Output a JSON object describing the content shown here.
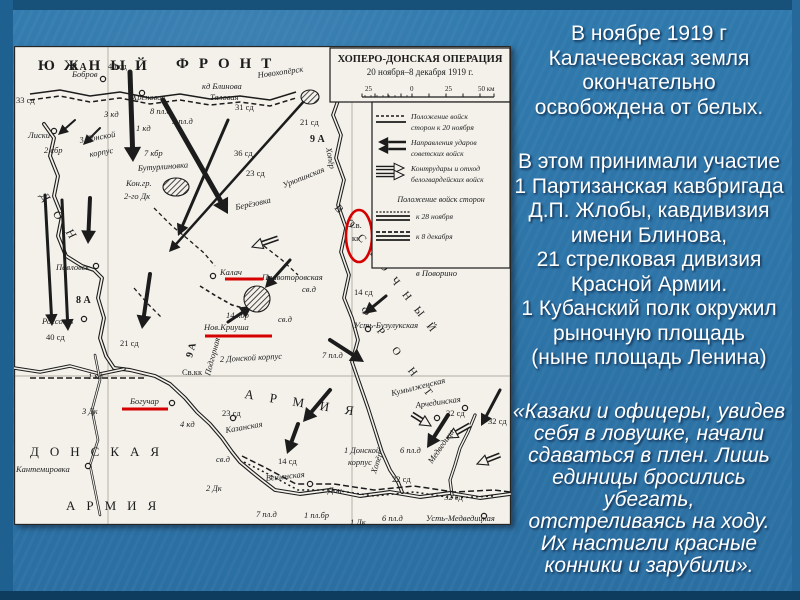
{
  "slide": {
    "background_color": "#2e76a9",
    "frame_color": "#175079",
    "text_color": "#ffffff",
    "paragraph1": {
      "lines": [
        "В ноябре 1919 г",
        "Калачеевская земля",
        "окончательно",
        "освобождена от белых."
      ]
    },
    "paragraph2": {
      "lines": [
        "В этом принимали участие",
        "1 Партизанская кавбригада",
        "Д.П. Жлобы,  кавдивизия",
        "имени Блинова,",
        "21 стрелковая дивизия",
        "Красной Армии.",
        "1 Кубанский полк окружил",
        "рыночную площадь",
        "(ныне площадь Ленина)"
      ]
    },
    "quote": {
      "lines": [
        "«Казаки и офицеры, увидев",
        "себя в ловушке,  начали",
        "сдаваться в плен. Лишь",
        "единицы бросились",
        "убегать,",
        "отстреливаясь на ходу.",
        "Их настигли красные",
        "конники и зарубили»."
      ]
    }
  },
  "map": {
    "paper_color": "#f3f1ea",
    "ink_color": "#1c1c1c",
    "red_color": "#d60000",
    "title": {
      "line1": "ХОПЕРО-ДОНСКАЯ ОПЕРАЦИЯ",
      "line2": "20 ноября–8 декабря 1919 г."
    },
    "scale": {
      "labels": [
        "25",
        "0",
        "25",
        "50 км"
      ]
    },
    "legend": {
      "item1": [
        "Положение войск",
        "сторон к 20 ноября"
      ],
      "item2": [
        "Направления ударов",
        "советских войск"
      ],
      "item3": [
        "Контрудары и отход",
        "белогвардейских войск"
      ],
      "header": "Положение войск сторон",
      "item4": "к 28 ноября",
      "item5": "к 8 декабря"
    },
    "grid": {
      "verticals": [
        94,
        338
      ],
      "horizontals": [
        330
      ]
    },
    "labels": [
      {
        "t": "ЮЖНЫЙ",
        "x": 24,
        "y": 24,
        "s": 15,
        "sp": 10,
        "b": 1
      },
      {
        "t": "ФРОНТ",
        "x": 162,
        "y": 22,
        "s": 15,
        "sp": 10,
        "b": 1
      },
      {
        "t": "ДОНСКАЯ",
        "x": 16,
        "y": 410,
        "s": 13,
        "sp": 11
      },
      {
        "t": "АРМИЯ",
        "x": 52,
        "y": 464,
        "s": 13,
        "sp": 11
      },
      {
        "t": "АРМИЯ",
        "x": 230,
        "y": 352,
        "s": 13,
        "sp": 16,
        "r": 9
      },
      {
        "t": "ДОН",
        "x": 26,
        "y": 150,
        "s": 12,
        "sp": 14,
        "r": 55,
        "i": 1
      },
      {
        "t": "ВОСТОЧНЫЙ",
        "x": 320,
        "y": 162,
        "s": 11,
        "sp": 11,
        "r": 52
      },
      {
        "t": "ФРОНТ",
        "x": 346,
        "y": 264,
        "s": 11,
        "sp": 18,
        "r": 52
      },
      {
        "t": "8 А",
        "x": 58,
        "y": 24,
        "s": 10,
        "b": 1
      },
      {
        "t": "40 сд",
        "x": 94,
        "y": 23
      },
      {
        "t": "Бобров",
        "x": 58,
        "y": 31,
        "i": 1
      },
      {
        "t": "кд Блинова",
        "x": 188,
        "y": 43,
        "i": 1
      },
      {
        "t": "Таловая",
        "x": 196,
        "y": 54,
        "i": 1
      },
      {
        "t": "Новохопёрск",
        "x": 244,
        "y": 32,
        "i": 1,
        "r": -8
      },
      {
        "t": "Хреновое",
        "x": 118,
        "y": 54,
        "i": 1
      },
      {
        "t": "33 сд",
        "x": 2,
        "y": 57
      },
      {
        "t": "31 сд",
        "x": 221,
        "y": 64
      },
      {
        "t": "3 кд",
        "x": 90,
        "y": 71,
        "i": 1
      },
      {
        "t": "8 пл.д",
        "x": 136,
        "y": 68,
        "i": 1
      },
      {
        "t": "5 пл.д",
        "x": 158,
        "y": 78,
        "i": 1
      },
      {
        "t": "21 сд",
        "x": 286,
        "y": 79
      },
      {
        "t": "1 кд",
        "x": 122,
        "y": 85,
        "i": 1
      },
      {
        "t": "Лиски",
        "x": 14,
        "y": 92,
        "i": 1
      },
      {
        "t": "9 А",
        "x": 296,
        "y": 96,
        "s": 10,
        "b": 1
      },
      {
        "t": "3 Донской",
        "x": 66,
        "y": 97,
        "i": 1,
        "r": -10
      },
      {
        "t": "корпус",
        "x": 76,
        "y": 111,
        "i": 1,
        "r": -10
      },
      {
        "t": "2 сбр",
        "x": 30,
        "y": 107,
        "i": 1
      },
      {
        "t": "7 кбр",
        "x": 130,
        "y": 110,
        "i": 1
      },
      {
        "t": "36 сд",
        "x": 220,
        "y": 110
      },
      {
        "t": "Бутурлиновка",
        "x": 124,
        "y": 125,
        "i": 1,
        "r": -4
      },
      {
        "t": "23 сд",
        "x": 232,
        "y": 130
      },
      {
        "t": "Кон.гр.",
        "x": 112,
        "y": 140,
        "i": 1
      },
      {
        "t": "2-го Дк",
        "x": 110,
        "y": 153,
        "i": 1
      },
      {
        "t": "Урюпинская",
        "x": 270,
        "y": 142,
        "i": 1,
        "r": -22
      },
      {
        "t": "Берёзовка",
        "x": 222,
        "y": 164,
        "i": 1,
        "r": -12
      },
      {
        "t": "Хопёр",
        "x": 312,
        "y": 102,
        "i": 1,
        "r": 80
      },
      {
        "t": "Св.",
        "x": 336,
        "y": 182
      },
      {
        "t": "кк",
        "x": 338,
        "y": 195
      },
      {
        "t": "Павловск",
        "x": 42,
        "y": 224,
        "i": 1
      },
      {
        "t": "в Поворино",
        "x": 402,
        "y": 230,
        "i": 1
      },
      {
        "t": "Калач",
        "x": 206,
        "y": 229,
        "i": 1
      },
      {
        "t": "Правоторовская",
        "x": 248,
        "y": 234,
        "i": 1
      },
      {
        "t": "св.д",
        "x": 288,
        "y": 246,
        "i": 1
      },
      {
        "t": "14 сд",
        "x": 340,
        "y": 249
      },
      {
        "t": "8 А",
        "x": 62,
        "y": 257,
        "s": 10,
        "b": 1
      },
      {
        "t": "14 кбр",
        "x": 212,
        "y": 272,
        "i": 1
      },
      {
        "t": "св.д",
        "x": 264,
        "y": 276,
        "i": 1
      },
      {
        "t": "Россошь",
        "x": 28,
        "y": 278,
        "i": 1
      },
      {
        "t": "Усть-Бузулукская",
        "x": 340,
        "y": 282,
        "i": 1
      },
      {
        "t": "Нов.Криуша",
        "x": 190,
        "y": 284,
        "i": 1
      },
      {
        "t": "40 сд",
        "x": 32,
        "y": 294
      },
      {
        "t": "21 сд",
        "x": 106,
        "y": 300
      },
      {
        "t": "9 А",
        "x": 178,
        "y": 312,
        "s": 10,
        "r": -75,
        "b": 1
      },
      {
        "t": "Подгорная",
        "x": 196,
        "y": 330,
        "i": 1,
        "r": -75
      },
      {
        "t": "7 пл.д",
        "x": 308,
        "y": 312,
        "i": 1
      },
      {
        "t": "2 Донской корпус",
        "x": 206,
        "y": 316,
        "i": 1,
        "r": -3
      },
      {
        "t": "1 кд",
        "x": 74,
        "y": 333,
        "i": 1
      },
      {
        "t": "Св.кк",
        "x": 168,
        "y": 329
      },
      {
        "t": "Богучар",
        "x": 116,
        "y": 358,
        "i": 1
      },
      {
        "t": "3 Дк",
        "x": 68,
        "y": 368,
        "i": 1
      },
      {
        "t": "23 сд",
        "x": 208,
        "y": 370
      },
      {
        "t": "4 кд",
        "x": 166,
        "y": 381,
        "i": 1
      },
      {
        "t": "Казанская",
        "x": 212,
        "y": 387,
        "i": 1,
        "r": -10
      },
      {
        "t": "Кумылженская",
        "x": 378,
        "y": 350,
        "i": 1,
        "r": -14
      },
      {
        "t": "Арчединская",
        "x": 402,
        "y": 362,
        "i": 1,
        "r": -8
      },
      {
        "t": "22 сд",
        "x": 432,
        "y": 370
      },
      {
        "t": "32 сд",
        "x": 474,
        "y": 378
      },
      {
        "t": "1 Донской",
        "x": 330,
        "y": 407,
        "i": 1
      },
      {
        "t": "корпус",
        "x": 334,
        "y": 419,
        "i": 1
      },
      {
        "t": "6 пл.д",
        "x": 386,
        "y": 407,
        "i": 1
      },
      {
        "t": "Медведица",
        "x": 418,
        "y": 418,
        "i": 1,
        "r": -55
      },
      {
        "t": "Хопёр",
        "x": 362,
        "y": 428,
        "i": 1,
        "r": -72
      },
      {
        "t": "св.д",
        "x": 202,
        "y": 416,
        "i": 1
      },
      {
        "t": "14 сд",
        "x": 264,
        "y": 418
      },
      {
        "t": "Кантемировка",
        "x": 2,
        "y": 426,
        "i": 1
      },
      {
        "t": "Вешенская",
        "x": 252,
        "y": 435,
        "i": 1,
        "r": -6
      },
      {
        "t": "22 сд",
        "x": 378,
        "y": 436
      },
      {
        "t": "2 Дк",
        "x": 192,
        "y": 445,
        "i": 1
      },
      {
        "t": "Дон",
        "x": 314,
        "y": 447,
        "i": 1
      },
      {
        "t": "32 сд",
        "x": 430,
        "y": 454
      },
      {
        "t": "7 пл.д",
        "x": 242,
        "y": 471,
        "i": 1
      },
      {
        "t": "1 пл.бр",
        "x": 290,
        "y": 472,
        "i": 1
      },
      {
        "t": "6 пл.д",
        "x": 368,
        "y": 475,
        "i": 1
      },
      {
        "t": "1 Дк",
        "x": 336,
        "y": 479,
        "i": 1
      },
      {
        "t": "Усть-Медведицкая",
        "x": 412,
        "y": 475,
        "i": 1
      }
    ],
    "towns": [
      [
        89,
        33
      ],
      [
        128,
        47
      ],
      [
        40,
        85
      ],
      [
        82,
        220
      ],
      [
        70,
        273
      ],
      [
        199,
        230
      ],
      [
        158,
        357
      ],
      [
        74,
        420
      ],
      [
        354,
        283
      ],
      [
        451,
        362
      ],
      [
        423,
        372
      ],
      [
        296,
        438
      ],
      [
        470,
        470
      ],
      [
        219,
        372
      ]
    ],
    "hatched": [
      {
        "cx": 296,
        "cy": 51,
        "rx": 9,
        "ry": 7
      },
      {
        "cx": 162,
        "cy": 141,
        "rx": 13,
        "ry": 9
      },
      {
        "cx": 243,
        "cy": 253,
        "rx": 13,
        "ry": 13
      }
    ],
    "rivers": [
      {
        "pts": "30,78 40,92 36,110 44,130 40,150 48,170 44,190 52,210 68,220 80,224 88,232 84,252 90,272 86,292 92,310 100,322 116,324 141,330 156,338 171,352 183,366 196,378 208,392 218,406 226,416 238,426 248,434 261,444 286,448 316,444 346,450 376,446 406,451 436,447 466,452 496,448",
        "w": 1.7
      },
      {
        "pts": "0,322 26,326 56,320 86,328 110,323",
        "w": 1.5
      },
      {
        "pts": "321,32 326,49 319,69 327,89 322,112 330,134 324,159 332,182 327,206 335,229 330,252 338,272 344,294 338,316 346,339 354,362 361,384 368,406 376,424 384,436 388,446",
        "w": 1.6
      },
      {
        "pts": "461,369 454,386 446,402 441,419 436,434 438,449",
        "w": 1.4
      },
      {
        "pts": "81,309 86,334 78,364 84,394 76,419 81,444 86,469",
        "w": 1.1
      }
    ],
    "frontlines": [
      {
        "pts": "16,48 46,44 76,50 106,46 136,52 166,48 196,53 226,50 256,54 282,46",
        "w": 1.5
      },
      {
        "pts": "16,54 46,50 76,56 106,52 136,58 166,54 196,59 226,56 256,60 282,52",
        "dash": "5,3",
        "w": 1.5
      },
      {
        "pts": "140,162 158,180 175,194 190,207 201,220",
        "dash": "4,3",
        "w": 1.3
      },
      {
        "pts": "250,200 268,214 284,229",
        "dash": "4,3",
        "w": 1.3
      },
      {
        "pts": "120,242 134,258 148,272",
        "dash": "4,3",
        "w": 1.3
      },
      {
        "pts": "16,332 131,332",
        "dash": "6,3",
        "w": 1.4
      },
      {
        "pts": "186,240 202,250 218,259 233,263",
        "dash": "4,3",
        "w": 1.6
      },
      {
        "pts": "228,410 252,422 282,438 320,438 360,444 400,440 440,446 480,444 496,446",
        "dash": "6,3",
        "w": 1.5
      },
      {
        "pts": "230,416 254,428 284,444 320,444 360,450 400,446 440,452 480,450",
        "dash": "2,3",
        "w": 1.5
      }
    ],
    "arrows": [
      [
        116,
        26,
        119,
        116,
        5
      ],
      [
        149,
        54,
        214,
        168,
        5
      ],
      [
        291,
        54,
        155,
        206,
        2.5
      ],
      [
        214,
        74,
        164,
        190,
        3
      ],
      [
        76,
        152,
        74,
        198,
        4
      ],
      [
        31,
        149,
        38,
        280,
        3
      ],
      [
        48,
        154,
        54,
        285,
        3
      ],
      [
        136,
        228,
        128,
        283,
        4
      ],
      [
        276,
        214,
        251,
        242,
        3
      ],
      [
        214,
        276,
        238,
        260,
        3
      ],
      [
        316,
        294,
        350,
        316,
        4
      ],
      [
        372,
        250,
        350,
        268,
        3
      ],
      [
        316,
        344,
        289,
        376,
        4
      ],
      [
        284,
        378,
        273,
        408,
        4
      ],
      [
        434,
        369,
        413,
        402,
        4
      ],
      [
        486,
        344,
        467,
        380,
        3
      ],
      [
        61,
        74,
        44,
        89,
        2
      ],
      [
        86,
        82,
        69,
        99,
        2
      ]
    ],
    "counter_arrows": [
      [
        264,
        192,
        238,
        201
      ],
      [
        456,
        379,
        433,
        392
      ],
      [
        486,
        409,
        463,
        418
      ],
      [
        398,
        368,
        417,
        380
      ]
    ],
    "red_marks": {
      "underlines": [
        [
          211,
          233,
          249
        ],
        [
          191,
          290,
          258
        ],
        [
          108,
          363,
          154
        ]
      ],
      "ellipse": {
        "cx": 345,
        "cy": 190,
        "rx": 13,
        "ry": 26
      }
    }
  }
}
